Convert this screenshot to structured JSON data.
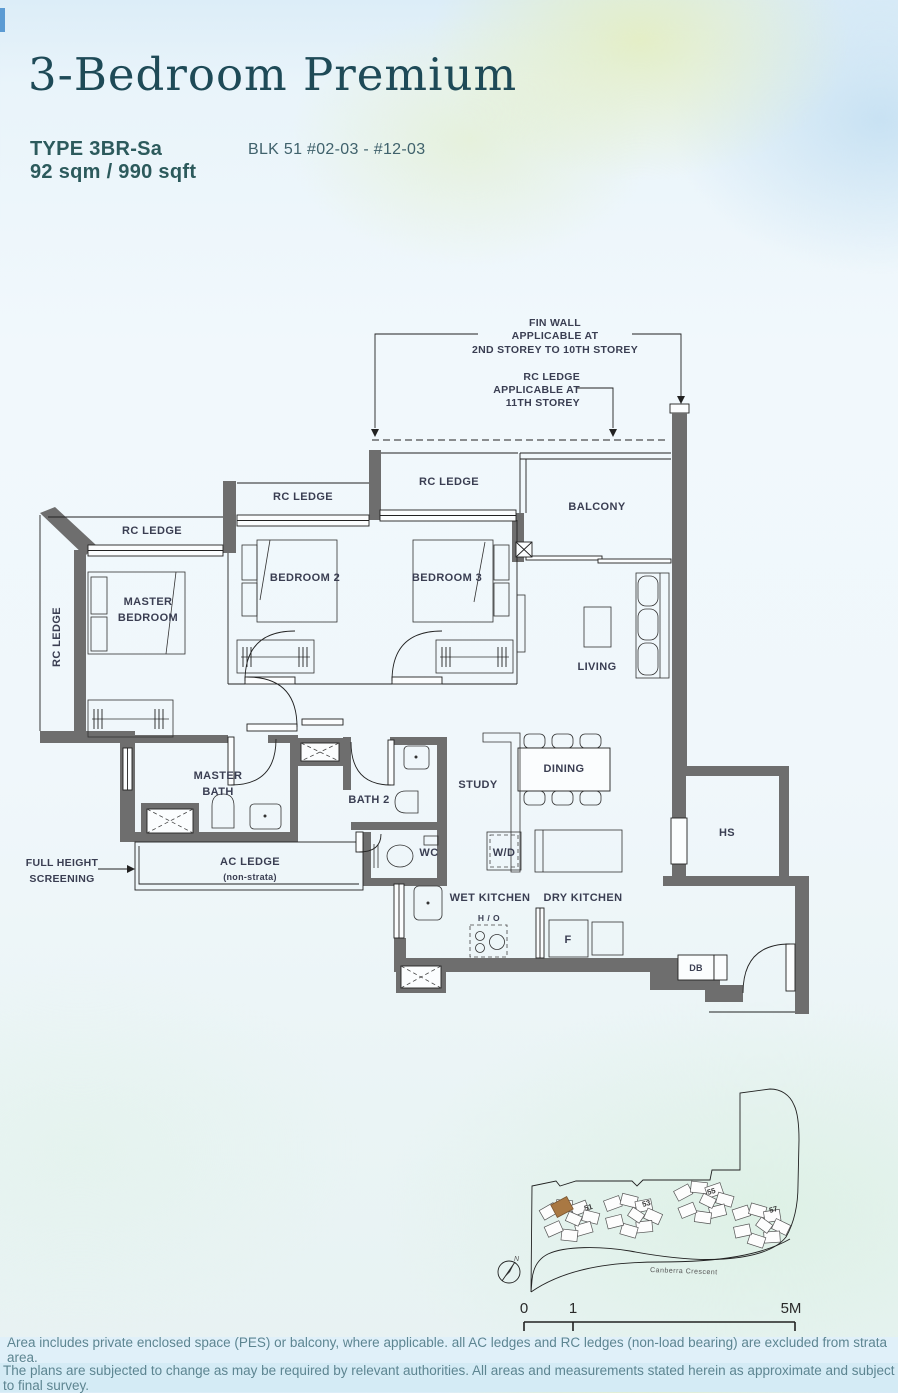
{
  "header": {
    "title": "3-Bedroom Premium",
    "type": "TYPE 3BR-Sa",
    "area": "92 sqm / 990 sqft",
    "block": "BLK 51 #02-03 - #12-03"
  },
  "plan": {
    "annotations": {
      "fin_wall_l1": "FIN WALL",
      "fin_wall_l2": "APPLICABLE AT",
      "fin_wall_l3": "2ND STOREY TO 10TH STOREY",
      "rc11_l1": "RC LEDGE",
      "rc11_l2": "APPLICABLE AT",
      "rc11_l3": "11TH STOREY",
      "fhs_l1": "FULL HEIGHT",
      "fhs_l2": "SCREENING"
    },
    "labels": {
      "rc_ledge": "RC LEDGE",
      "master_bedroom_l1": "MASTER",
      "master_bedroom_l2": "BEDROOM",
      "bedroom2": "BEDROOM 2",
      "bedroom3": "BEDROOM 3",
      "balcony": "BALCONY",
      "living": "LIVING",
      "dining": "DINING",
      "study": "STUDY",
      "master_bath_l1": "MASTER",
      "master_bath_l2": "BATH",
      "bath2": "BATH 2",
      "wc": "WC",
      "ac_ledge": "AC LEDGE",
      "ac_ledge_note": "(non-strata)",
      "wd": "W/D",
      "wet_kitchen": "WET KITCHEN",
      "dry_kitchen": "DRY KITCHEN",
      "hob": "H / O",
      "fridge": "F",
      "db": "DB",
      "hs": "HS"
    }
  },
  "sitemap": {
    "block_numbers": [
      "51",
      "53",
      "55",
      "57"
    ],
    "road_name": "Canberra Crescent",
    "compass": "N",
    "scale_ticks": [
      "0",
      "1",
      "5M"
    ],
    "highlight_color": "#a97843"
  },
  "footer": {
    "line1": "Area includes private enclosed space (PES) or balcony, where applicable. all AC ledges and RC ledges (non-load bearing) are excluded from strata area.",
    "line2": "The plans are subjected to change as may be required by relevant authorities. All areas and measurements stated herein as approximate and subject to final survey."
  },
  "colors": {
    "wall": "#6e6e6e",
    "label": "#3a3e52",
    "title": "#1e4a57",
    "accent_teal": "#2c5a5c",
    "highlight_unit": "#a97843"
  }
}
